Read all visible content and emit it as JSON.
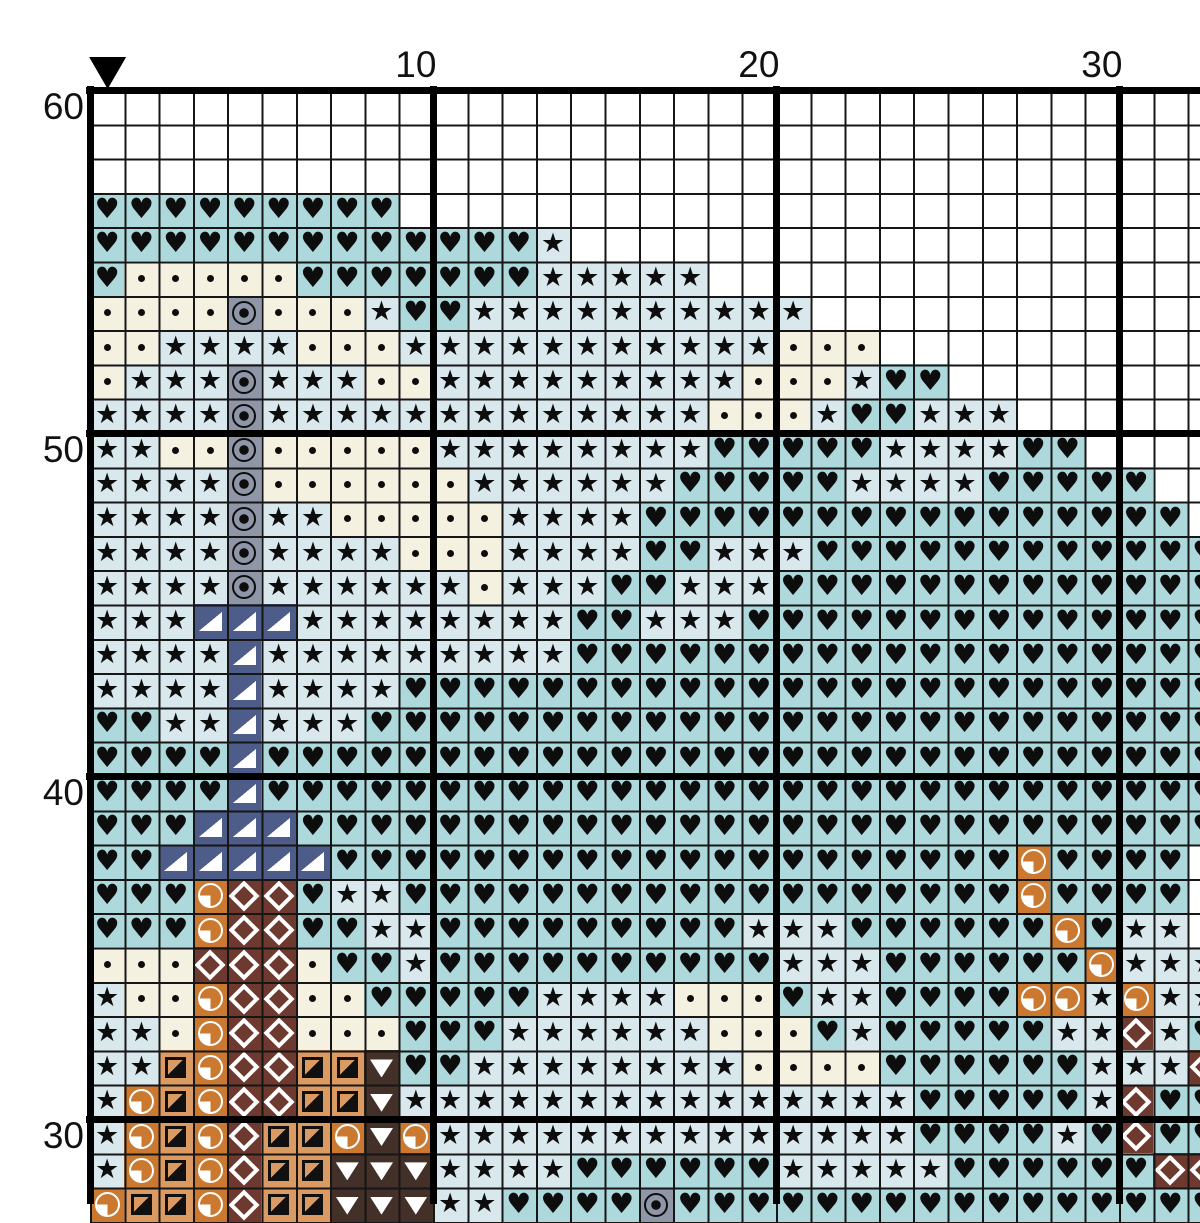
{
  "header": {
    "col_labels": [
      {
        "label": "10",
        "col": 10
      },
      {
        "label": "20",
        "col": 20
      },
      {
        "label": "30",
        "col": 30
      }
    ],
    "marker": {
      "shape": "triangle-down",
      "col": 1,
      "color": "#000000"
    }
  },
  "row_labels": [
    {
      "label": "60",
      "row_index": 0
    },
    {
      "label": "50",
      "row_index": 10
    },
    {
      "label": "40",
      "row_index": 20
    },
    {
      "label": "30",
      "row_index": 30
    }
  ],
  "grid_meta": {
    "cols": 33,
    "visible_rows": 33,
    "cell_px": 34.3,
    "bold_line_every": 10,
    "thin_line_color": "#161616",
    "bold_line_color": "#000000",
    "row_numbers_top_to_bottom": [
      60,
      59,
      58,
      57,
      56,
      55,
      54,
      53,
      52,
      51,
      50,
      49,
      48,
      47,
      46,
      45,
      44,
      43,
      42,
      41,
      40,
      39,
      38,
      37,
      36,
      35,
      34,
      33,
      32,
      31,
      30,
      29,
      28
    ]
  },
  "palette": {
    ".": {
      "name": "unstitched",
      "bg": "#ffffff",
      "glyph": "none"
    },
    "h": {
      "name": "heart-on-teal",
      "bg": "#aed9dc",
      "glyph": "heart",
      "char": "♥"
    },
    "s": {
      "name": "star-on-pale-blue",
      "bg": "#d9e8ed",
      "glyph": "star",
      "char": "★"
    },
    "d": {
      "name": "dot-on-cream",
      "bg": "#f5f1e1",
      "glyph": "dot"
    },
    "o": {
      "name": "fisheye-on-gray",
      "bg": "#8e96a7",
      "glyph": "fisheye"
    },
    "n": {
      "name": "white-corner-triangle-on-navy",
      "bg": "#4d5c88",
      "glyph": "tri-corner"
    },
    "q": {
      "name": "quarter-pie-on-orange",
      "bg": "#cb7930",
      "glyph": "pie"
    },
    "Q": {
      "name": "diagonal-square-on-tan",
      "bg": "#db9a62",
      "glyph": "square-diagonal"
    },
    "D": {
      "name": "diamond-outline-on-brown",
      "bg": "#6e3a2f",
      "glyph": "diamond-outline"
    },
    "v": {
      "name": "white-triangle-on-darkbrown",
      "bg": "#433028",
      "glyph": "triangle-down"
    }
  },
  "grid_rows": [
    ".................................",
    ".................................",
    ".................................",
    "hhhhhhhhh........................",
    "hhhhhhhhhhhhhs...................",
    "hdddddhhhhhhhsssss...............",
    "ddddodddshhssssssssss............",
    "ddssssdddsssssssssssddd..........",
    "dsssosssddsssssssssdddshh........",
    "ssssosssssssssssssdddshhsss......",
    "ssddodddddsssssssshhhhhsssshh....",
    "ssssoddddddsssssshhhhhsssshhhhh..",
    "ssssossdddddsssshhhhhhhhhhhhhhhh.",
    "ssssossssdddsssshhssshhhhhhhhhhhh",
    "ssssossssssdssshhssshhhhhhhhhhhhh",
    "sssnnnsssssssshhssshhhhhhhhhhhhhh",
    "ssssnssssssssshhhhhhhhhhhhhhhhhhh",
    "ssssnsssshhhhhhhhhhhhhhhhhhhhhhhh",
    "hhssnssshhhhhhhhhhhhhhhhhhhhhhhhh",
    "hhhhnhhhhhhhhhhhhhhhhhhhhhhhhhhhh",
    "hhhhnhhhhhhhhhhhhhhhhhhhhhhhhhhhh",
    "hhhnnnhhhhhhhhhhhhhhhhhhhhhhhhhhh",
    "hhnnnnnhhhhhhhhhhhhhhhhhhhhqhhhh",
    "hhhqDDhsshhhhhhhhhhhhhhhhhhqhhhh",
    "hhhqDDhhsshhhhhhhhhssshhhhhhqhss",
    "dddDDDdhhshhhhhhhhhhssshhhhhhqsss",
    "sddqDDddhhhhhssssdddhsshhhhqqsqss",
    "ssdqDDdddhhhssssssdddhshhhhhssDsh",
    "ssQqDDQQvhhssssssssddddhhhhhhsssDh",
    "sqQqDDQQvssssssssssssssshhhhhsDhhv",
    "sqQqDQQqvqsssssssssssssshhhhshDhh",
    "sqQqDQQvvvsssshhhhhhssssshhhhhhDD",
    "qQQqDQQvvvsshhhhohhhhhhhhhhhhhhhh"
  ]
}
